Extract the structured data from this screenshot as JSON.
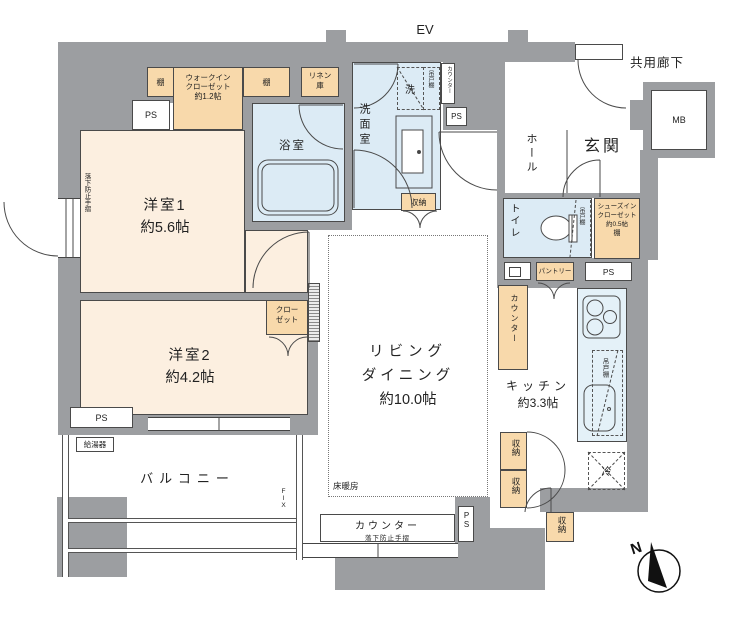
{
  "plan": {
    "compass_label": "N",
    "elevator": "EV",
    "common_corridor": "共用廊下",
    "meter_box": "MB",
    "rooms": {
      "western1_name": "洋室1",
      "western1_size": "約5.6帖",
      "western2_name": "洋室2",
      "western2_size": "約4.2帖",
      "living_line1": "リビング",
      "living_line2": "ダイニング",
      "living_size": "約10.0帖",
      "kitchen_name": "キッチン",
      "kitchen_size": "約3.3帖",
      "bath": "浴室",
      "washroom": "洗面室",
      "toilet": "トイレ",
      "hall": "ホール",
      "entrance": "玄関",
      "balcony": "バルコニー"
    },
    "storage": {
      "shelf": "棚",
      "wic_line1": "ウォークイン",
      "wic_line2": "クローゼット",
      "wic_line3": "約1.2帖",
      "linen_line1": "リネン",
      "linen_line2": "庫",
      "closet_line1": "クロー",
      "closet_line2": "ゼット",
      "sic_line1": "シューズイン",
      "sic_line2": "クローゼット",
      "sic_line3": "約0.5帖",
      "sic_line4": "棚",
      "pantry": "パントリー",
      "storage_unit": "収納"
    },
    "equipment": {
      "ps": "PS",
      "counter": "カウンター",
      "hanging_cupboard": "吊戸棚",
      "washer": "洗",
      "fridge": "冷",
      "water_heater": "給湯器",
      "floor_heating": "床暖房",
      "handrail": "落下防止手摺",
      "fix": "FIX"
    },
    "colors": {
      "wall": "#9c9ea1",
      "room_cream": "#fcefe0",
      "storage_orange": "#f8d9ab",
      "wet_blue": "#dcebf5",
      "kitchen_blue": "#e4f1f8"
    }
  }
}
